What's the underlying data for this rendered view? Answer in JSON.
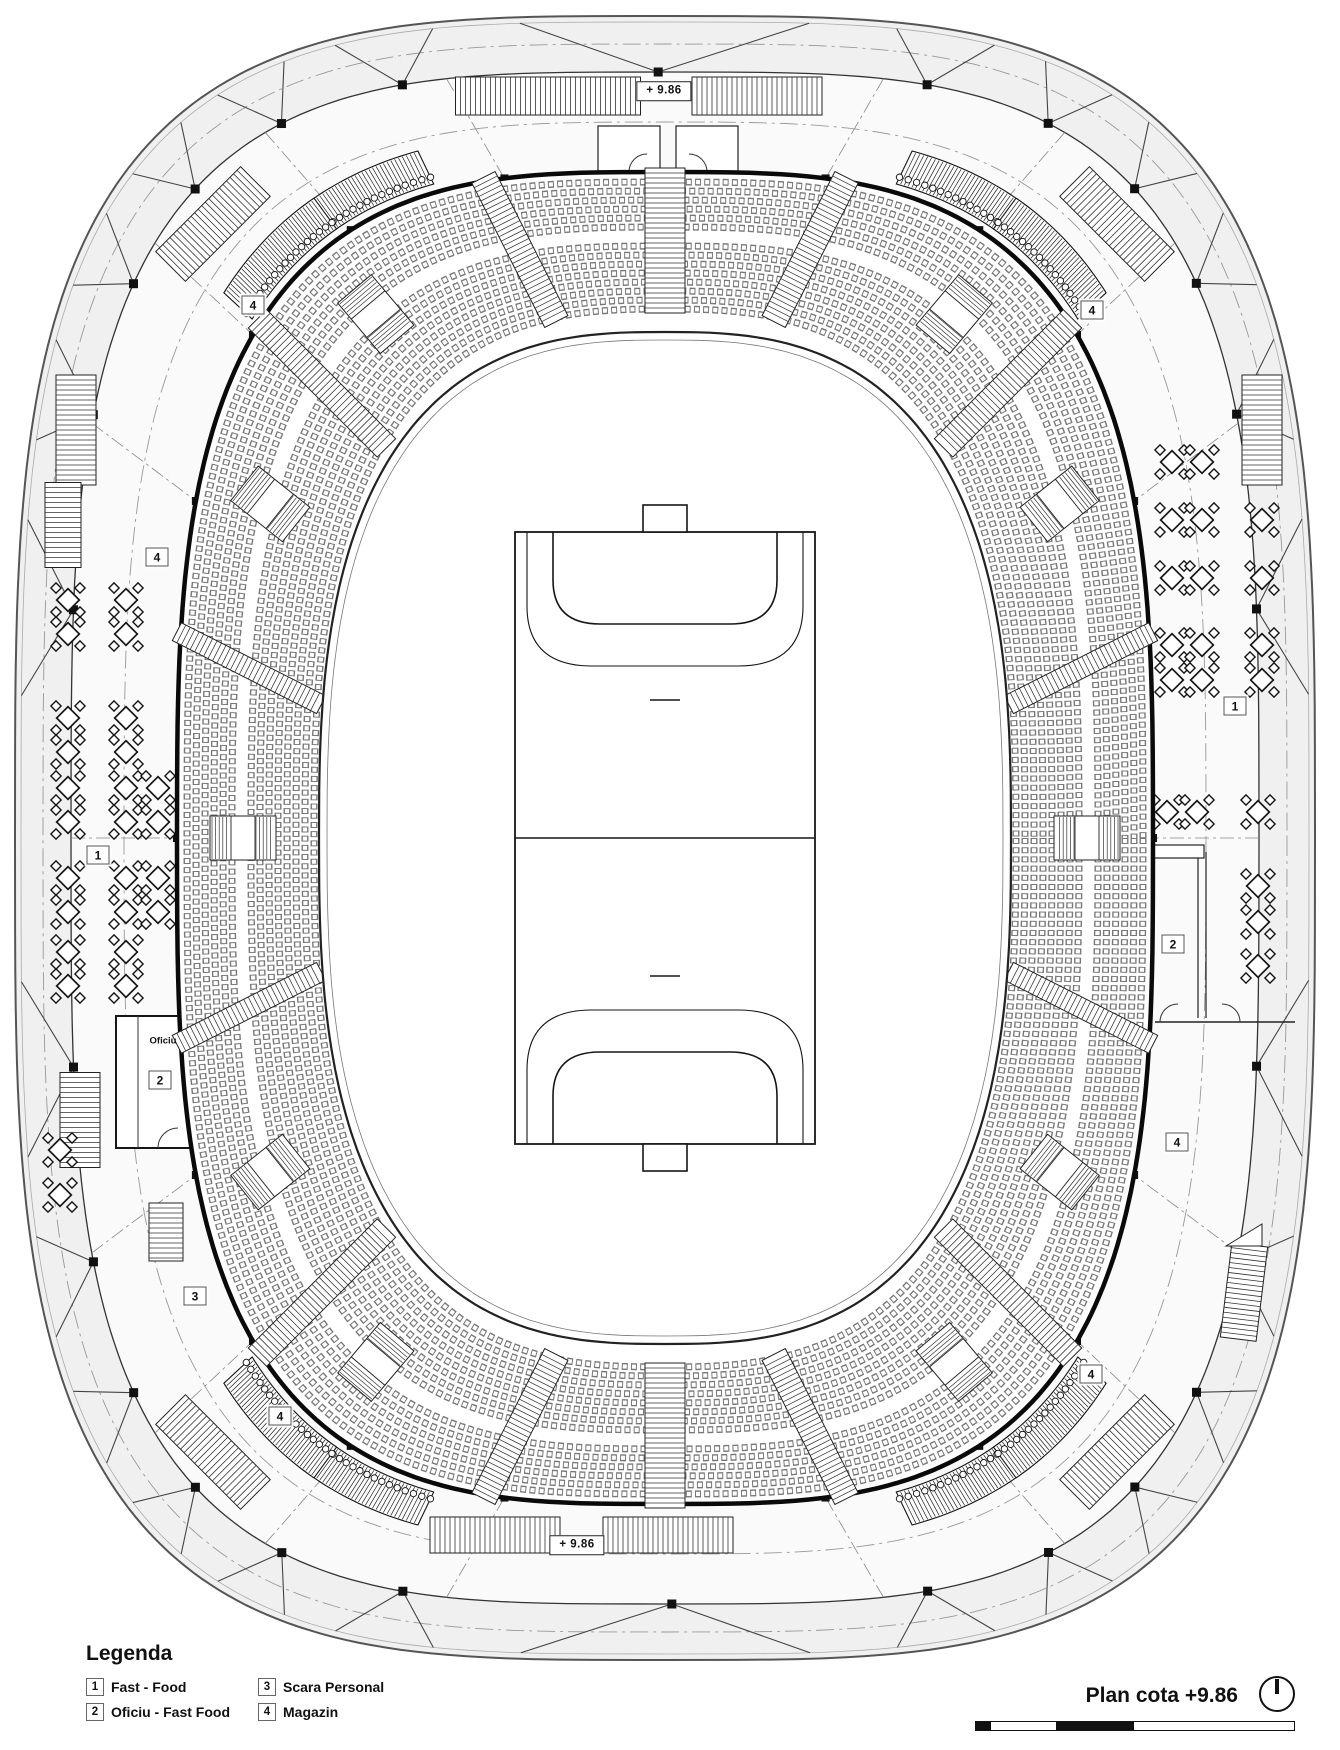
{
  "plan": {
    "title": "Plan cota +9.86",
    "legend": {
      "title": "Legenda",
      "items": [
        {
          "num": "1",
          "label": "Fast -  Food"
        },
        {
          "num": "2",
          "label": "Oficiu - Fast Food"
        },
        {
          "num": "3",
          "label": "Scara Personal"
        },
        {
          "num": "4",
          "label": "Magazin"
        }
      ]
    },
    "elevation_labels": [
      {
        "text": "+ 9.86",
        "x": 664,
        "y": 91
      },
      {
        "text": "+ 9.86",
        "x": 577,
        "y": 1545
      }
    ],
    "room_labels": [
      {
        "text": "Oficiu",
        "x": 163,
        "y": 1041
      }
    ],
    "markers": [
      {
        "num": "4",
        "x": 253,
        "y": 305
      },
      {
        "num": "4",
        "x": 1092,
        "y": 310
      },
      {
        "num": "4",
        "x": 157,
        "y": 557
      },
      {
        "num": "1",
        "x": 98,
        "y": 855
      },
      {
        "num": "2",
        "x": 160,
        "y": 1080
      },
      {
        "num": "3",
        "x": 195,
        "y": 1296
      },
      {
        "num": "4",
        "x": 280,
        "y": 1416
      },
      {
        "num": "1",
        "x": 1235,
        "y": 706
      },
      {
        "num": "2",
        "x": 1173,
        "y": 944
      },
      {
        "num": "4",
        "x": 1177,
        "y": 1142
      },
      {
        "num": "4",
        "x": 1091,
        "y": 1374
      }
    ],
    "north_arrow_icon": "north-arrow",
    "scale_bar_segments": [
      "black",
      "white",
      "black",
      "white"
    ],
    "colors": {
      "line": "#1a1a1a",
      "shell_fill": "#f0f0f0",
      "concourse_fill": "#fafafa",
      "paper": "#ffffff",
      "seat_line": "#787878"
    }
  }
}
